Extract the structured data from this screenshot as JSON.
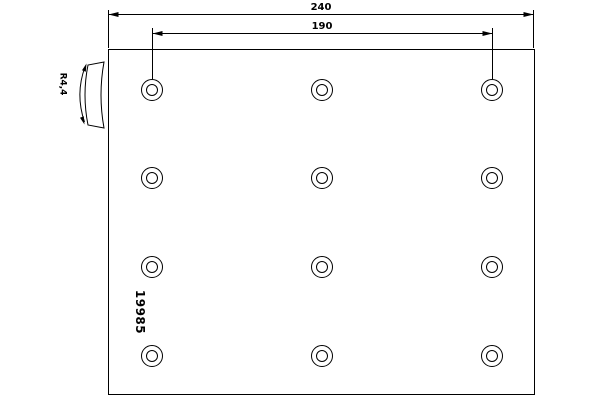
{
  "drawing": {
    "part_number": "19985",
    "dimensions": {
      "overall_width": "240",
      "hole_spacing": "190",
      "camber": "R4,4"
    },
    "holes": {
      "columns_x": [
        152,
        322,
        492
      ],
      "rows_y": [
        90,
        178,
        267,
        356
      ],
      "outer_radius": 10.5,
      "inner_radius": 5.5
    },
    "colors": {
      "line": "#000000",
      "background": "#ffffff"
    }
  }
}
